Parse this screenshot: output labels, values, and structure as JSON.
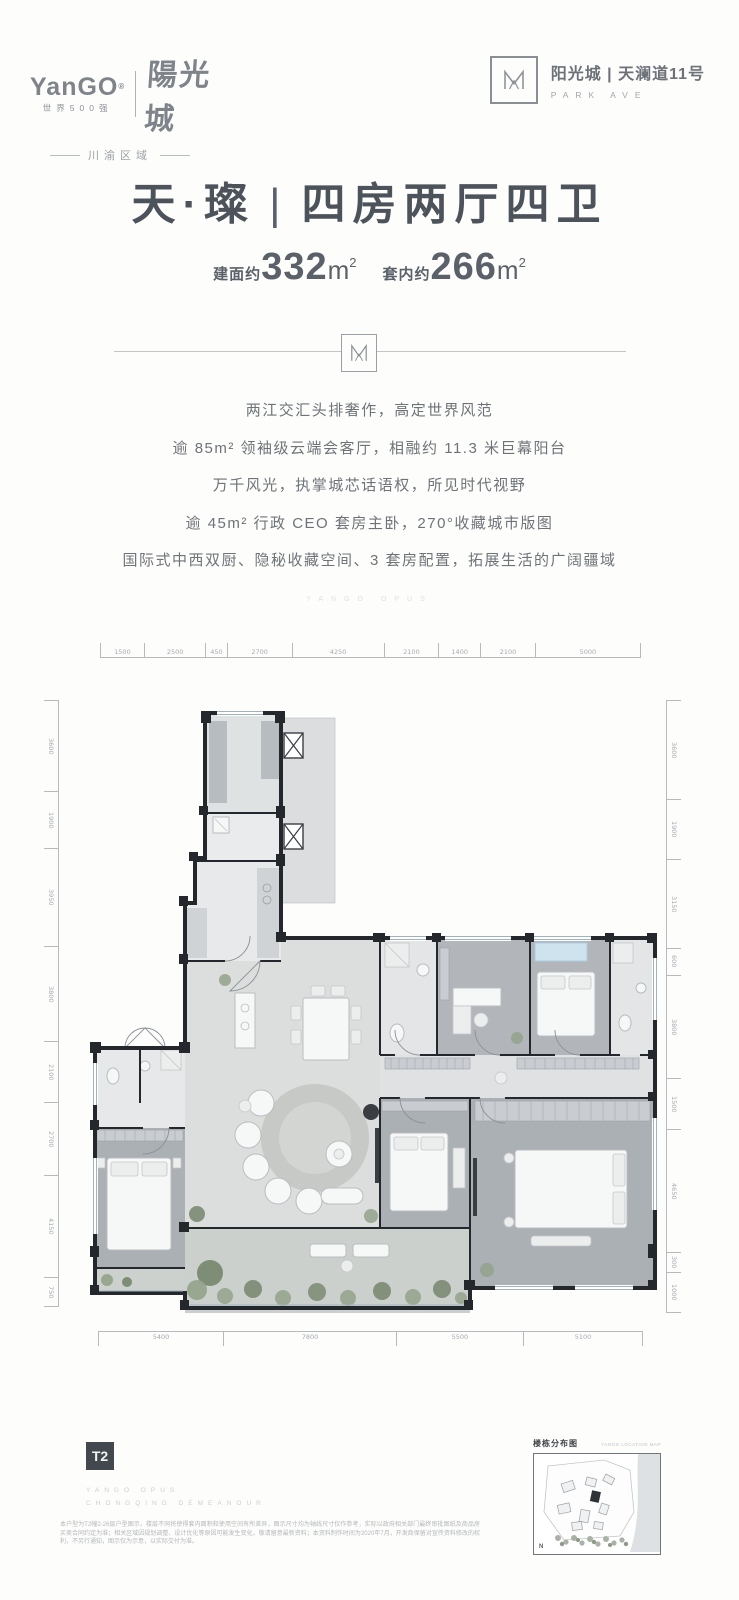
{
  "header": {
    "brand": {
      "logo": "YanGO",
      "reg": "®",
      "tagline": "世界500强",
      "brand_cn": "陽光城",
      "region": "川渝区域",
      "logo_icon": "m-mark"
    },
    "project": {
      "name_cn": "阳光城 | 天澜道11号",
      "name_en": "PARK AVE"
    }
  },
  "title": {
    "product": "天·璨",
    "separator": "|",
    "spec": "四房两厅四卫"
  },
  "area": {
    "gross_label": "建面约",
    "gross_value": "332",
    "net_label": "套内约",
    "net_value": "266",
    "unit": "m",
    "sup": "2"
  },
  "selling_points": [
    "两江交汇头排奢作，高定世界风范",
    "逾 85m² 领袖级云端会客厅，相融约 11.3 米巨幕阳台",
    "万千风光，执掌城芯话语权，所见时代视野",
    "逾 45m² 行政 CEO 套房主卧，270°收藏城市版图",
    "国际式中西双厨、隐秘收藏空间、3 套房配置，拓展生活的广阔疆域"
  ],
  "tagline_watermark": "YANGO OPUS",
  "floorplan": {
    "dims_top": [
      "1500",
      "2500",
      "450",
      "2700",
      "4250",
      "2100",
      "1400",
      "2100",
      "5000"
    ],
    "dims_left": [
      "3600",
      "1900",
      "3950",
      "3800",
      "2100",
      "2700",
      "4150",
      "750"
    ],
    "dims_right": [
      "3600",
      "1900",
      "3150",
      "600",
      "3800",
      "1500",
      "4650",
      "300",
      "1000"
    ],
    "dims_bottom": [
      "5400",
      "7800",
      "5500",
      "5100"
    ]
  },
  "footer": {
    "tower_label": "T2",
    "slogan_en_1": "YANGO OPUS",
    "slogan_en_2": "CHONGQING DEMEANOUR",
    "disclaimer": "本户型为T2幢2-26层户型图示，楼层不同将使得套内面积和使用空间有所差异，图示尺寸均为轴线尺寸仅作参考，实际以政府相关部门最终审批图纸及商品房买卖合同约定为准；相关区域因规划调整、设计优化等原因可能发生变化，敬请留意最新资料；本资料制作时间为2020年7月，开发商保留对宣传资料修改的权利，不另行通知，图示仅为示意，以实际交付为准。",
    "map": {
      "title_cn": "楼栋分布图",
      "title_en": "YANGO LOCATION MAP",
      "north": "N"
    }
  }
}
